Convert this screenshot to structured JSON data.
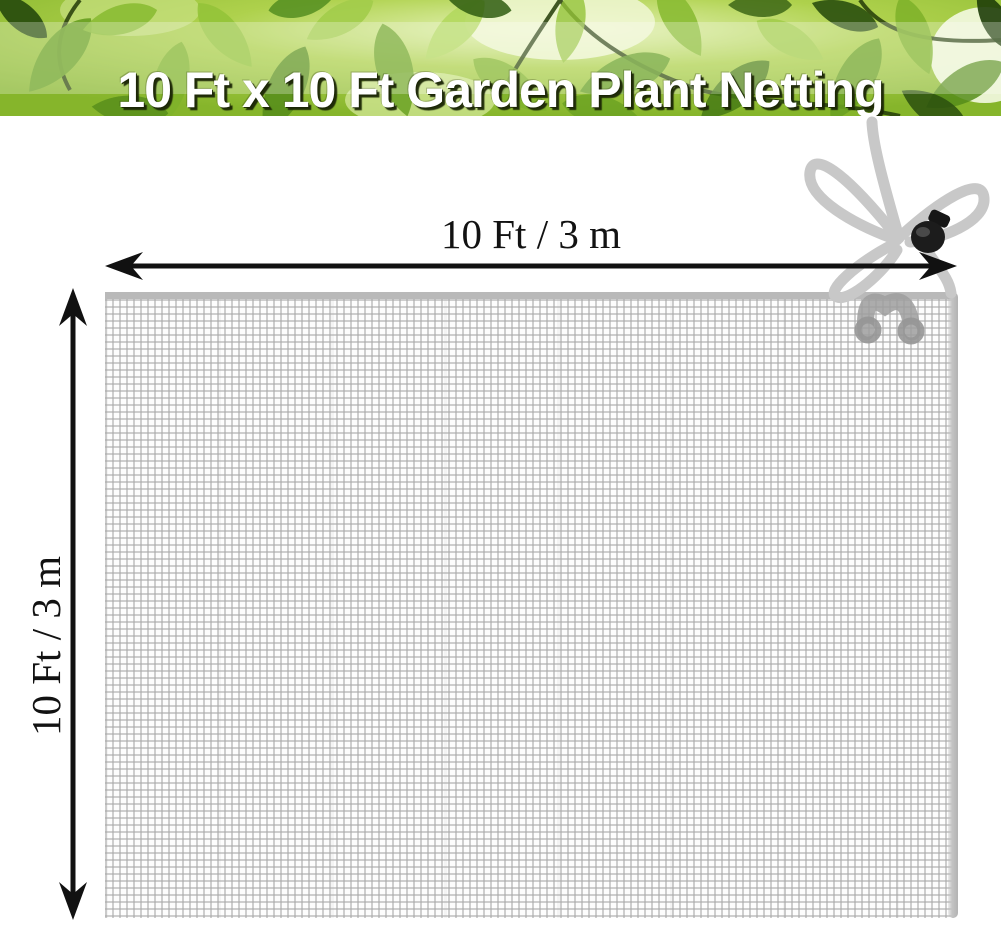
{
  "header": {
    "title": "10 Ft x 10 Ft Garden Plant Netting"
  },
  "dimensions": {
    "width_label": "10 Ft / 3 m",
    "height_label": "10 Ft / 3 m"
  },
  "colors": {
    "title_color": "#ffffff",
    "banner_green": "#8fbe2f",
    "banner_light_green": "#b3d85e",
    "arrow_black": "#111111",
    "mesh_edge": "#b9b9b9",
    "rope_gray": "#c8c8c8",
    "clip_gray": "#9e9e9e",
    "toggle_black": "#1c1c1c"
  }
}
